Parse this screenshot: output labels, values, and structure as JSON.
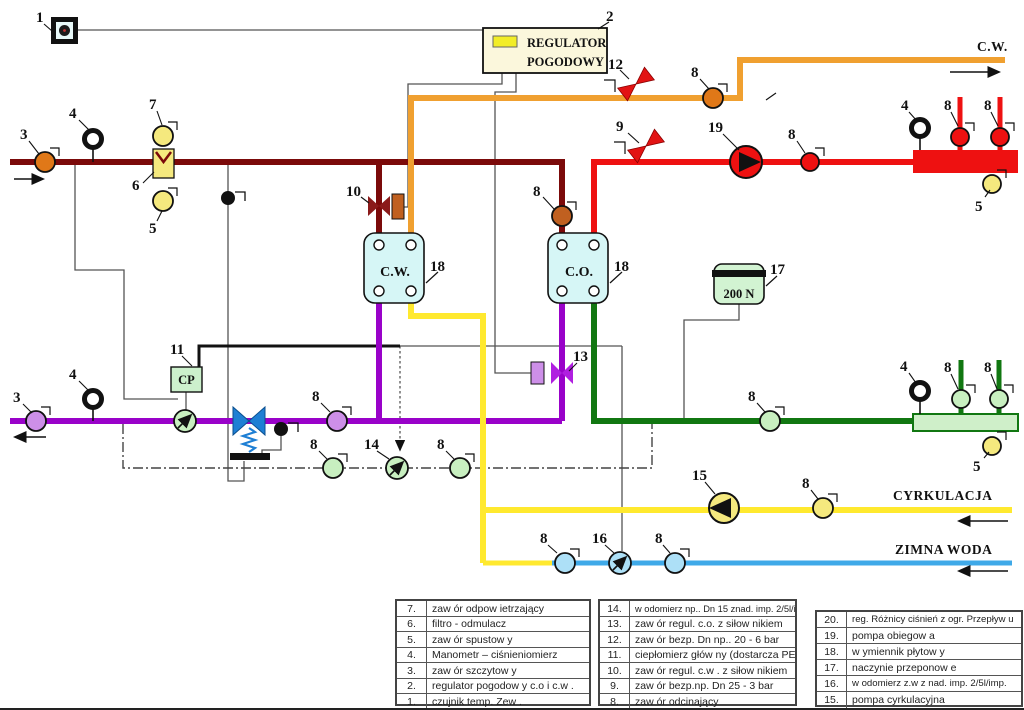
{
  "colors": {
    "supply_high": "#7B0A0A",
    "dhw_hot": "#F0A030",
    "co_supply": "#EE1111",
    "return_high": "#9902C9",
    "co_return": "#117711",
    "circulation": "#FFE92F",
    "cold_water": "#3FA9E8"
  },
  "diagram": {
    "nums": {
      "n1": "1",
      "n2": "2",
      "n3": "3",
      "n4": "4",
      "n5": "5",
      "n6": "6",
      "n7": "7",
      "n8": "8",
      "n9": "9",
      "n10": "10",
      "n11": "11",
      "n12": "12",
      "n13": "13",
      "n14": "14",
      "n15": "15",
      "n16": "16",
      "n17": "17",
      "n18": "18",
      "n19": "19"
    },
    "regulator": {
      "line1": "REGULATOR",
      "line2": "POGODOWY"
    },
    "exchanger_cw": "C.W.",
    "exchanger_co": "C.O.",
    "vessel_label": "200 N",
    "heat_meter_label": "CP",
    "flow_cw": "C.W.",
    "flow_circulation": "CYRKULACJA",
    "flow_cold": "ZIMNA WODA"
  },
  "legend": {
    "left": [
      {
        "no": "7.",
        "label": "zaw ór odpow ietrzający"
      },
      {
        "no": "6.",
        "label": "filtro - odmulacz"
      },
      {
        "no": "5.",
        "label": "zaw ór spustow y"
      },
      {
        "no": "4.",
        "label": "Manometr – ciśnieniomierz"
      },
      {
        "no": "3.",
        "label": "zaw ór szczytow y"
      },
      {
        "no": "2.",
        "label": "regulator pogodow y c.o i c.w ."
      },
      {
        "no": "1.",
        "label": "czujnik temp. Zew ."
      }
    ],
    "middle": [
      {
        "no": "14.",
        "label": "w odomierz np.. Dn 15 znad. imp. 2/5l/imp."
      },
      {
        "no": "13.",
        "label": "zaw ór regul. c.o. z siłow nikiem"
      },
      {
        "no": "12.",
        "label": "zaw ór bezp. Dn np.. 20 - 6 bar"
      },
      {
        "no": "11.",
        "label": "ciepłomierz głów ny (dostarcza PEC)"
      },
      {
        "no": "10.",
        "label": "zaw ór regul. c.w . z siłow nikiem"
      },
      {
        "no": "9.",
        "label": "zaw ór bezp.np. Dn 25 - 3 bar"
      },
      {
        "no": "8.",
        "label": "zaw ór odcinający"
      }
    ],
    "right": [
      {
        "no": "20.",
        "label": "reg. Różnicy ciśnień z ogr. Przepływ u"
      },
      {
        "no": "19.",
        "label": "pompa obiegow a"
      },
      {
        "no": "18.",
        "label": "w ymiennik płytow y"
      },
      {
        "no": "17.",
        "label": "naczynie przeponow e"
      },
      {
        "no": "16.",
        "label": "w odomierz z.w z nad. imp. 2/5l/imp."
      },
      {
        "no": "15.",
        "label": "pompa cyrkulacyjna"
      }
    ]
  }
}
